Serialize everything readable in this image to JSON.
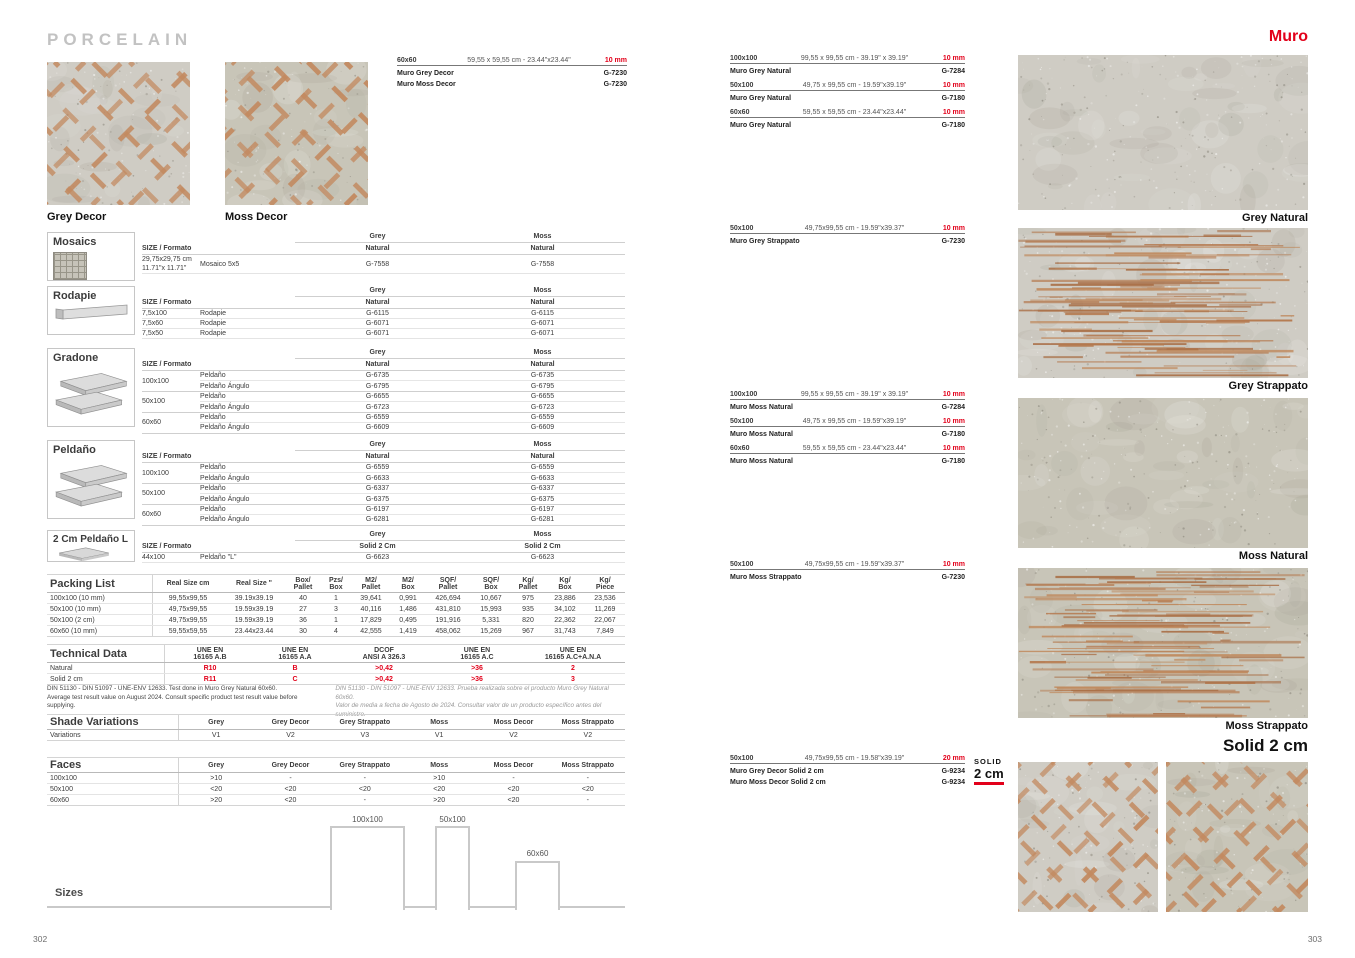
{
  "colors": {
    "accent": "#e2001a",
    "tile_grey": "#cfccc4",
    "tile_moss": "#c8c5b8",
    "dash": "#c38a60",
    "streak": "#b5794e"
  },
  "shared": {
    "size_header": "SIZE / Formato",
    "grey": "Grey",
    "moss": "Moss",
    "natural": "Natural",
    "solid": "Solid 2 Cm"
  },
  "left_page": {
    "brand_title": "PORCELAIN",
    "page_number": "302",
    "hero_tiles": [
      {
        "label": "Grey Decor"
      },
      {
        "label": "Moss Decor"
      }
    ],
    "top_spec": {
      "size": "60x60",
      "dims": "59,55 x 59,55 cm - 23.44\"x23.44\"",
      "thickness": "10 mm",
      "products": [
        {
          "name": "Muro Grey Decor",
          "code": "G-7230"
        },
        {
          "name": "Muro Moss Decor",
          "code": "G-7230"
        }
      ]
    },
    "mosaics": {
      "title": "Mosaics",
      "rows": [
        {
          "size": "29,75x29,75 cm\n11.71\"x 11.71\"",
          "product": "Mosaico 5x5",
          "grey": "G-7558",
          "moss": "G-7558"
        }
      ]
    },
    "rodapie": {
      "title": "Rodapie",
      "rows": [
        {
          "size": "7,5x100",
          "product": "Rodapie",
          "grey": "G-6115",
          "moss": "G-6115"
        },
        {
          "size": "7,5x60",
          "product": "Rodapie",
          "grey": "G-6071",
          "moss": "G-6071"
        },
        {
          "size": "7,5x50",
          "product": "Rodapie",
          "grey": "G-6071",
          "moss": "G-6071"
        }
      ]
    },
    "gradone": {
      "title": "Gradone",
      "groups": [
        {
          "size": "100x100",
          "items": [
            {
              "product": "Peldaño",
              "grey": "G-6735",
              "moss": "G-6735"
            },
            {
              "product": "Peldaño Ángulo",
              "grey": "G-6795",
              "moss": "G-6795"
            }
          ]
        },
        {
          "size": "50x100",
          "items": [
            {
              "product": "Peldaño",
              "grey": "G-6655",
              "moss": "G-6655"
            },
            {
              "product": "Peldaño Ángulo",
              "grey": "G-6723",
              "moss": "G-6723"
            }
          ]
        },
        {
          "size": "60x60",
          "items": [
            {
              "product": "Peldaño",
              "grey": "G-6559",
              "moss": "G-6559"
            },
            {
              "product": "Peldaño Ángulo",
              "grey": "G-6609",
              "moss": "G-6609"
            }
          ]
        }
      ]
    },
    "peldano": {
      "title": "Peldaño",
      "groups": [
        {
          "size": "100x100",
          "items": [
            {
              "product": "Peldaño",
              "grey": "G-6559",
              "moss": "G-6559"
            },
            {
              "product": "Peldaño Ángulo",
              "grey": "G-6633",
              "moss": "G-6633"
            }
          ]
        },
        {
          "size": "50x100",
          "items": [
            {
              "product": "Peldaño",
              "grey": "G-6337",
              "moss": "G-6337"
            },
            {
              "product": "Peldaño Ángulo",
              "grey": "G-6375",
              "moss": "G-6375"
            }
          ]
        },
        {
          "size": "60x60",
          "items": [
            {
              "product": "Peldaño",
              "grey": "G-6197",
              "moss": "G-6197"
            },
            {
              "product": "Peldaño Ángulo",
              "grey": "G-6281",
              "moss": "G-6281"
            }
          ]
        }
      ]
    },
    "peldano_l": {
      "title": "2 Cm Peldaño L",
      "rows": [
        {
          "size": "44x100",
          "product": "Peldaño \"L\"",
          "grey": "G-6623",
          "moss": "G-6623"
        }
      ]
    },
    "packing": {
      "title": "Packing List",
      "headers": [
        "Real Size cm",
        "Real Size \"",
        "Box/\nPallet",
        "Pzs/\nBox",
        "M2/\nPallet",
        "M2/\nBox",
        "SQF/\nPallet",
        "SQF/\nBox",
        "Kg/\nPallet",
        "Kg/\nBox",
        "Kg/\nPiece"
      ],
      "rows": [
        {
          "label": "100x100 (10 mm)",
          "values": [
            "99,55x99,55",
            "39.19x39.19",
            "40",
            "1",
            "39,641",
            "0,991",
            "426,694",
            "10,667",
            "975",
            "23,886",
            "23,536"
          ]
        },
        {
          "label": "50x100 (10 mm)",
          "values": [
            "49,75x99,55",
            "19.59x39.19",
            "27",
            "3",
            "40,116",
            "1,486",
            "431,810",
            "15,993",
            "935",
            "34,102",
            "11,269"
          ]
        },
        {
          "label": "50x100 (2 cm)",
          "values": [
            "49,75x99,55",
            "19.59x39.19",
            "36",
            "1",
            "17,829",
            "0,495",
            "191,916",
            "5,331",
            "820",
            "22,362",
            "22,067"
          ]
        },
        {
          "label": "60x60 (10 mm)",
          "values": [
            "59,55x59,55",
            "23.44x23.44",
            "30",
            "4",
            "42,555",
            "1,419",
            "458,062",
            "15,269",
            "967",
            "31,743",
            "7,849"
          ]
        }
      ]
    },
    "technical": {
      "title": "Technical Data",
      "headers": [
        "UNE EN\n16165 A.B",
        "UNE EN\n16165 A.A",
        "DCOF\nANSI A 326.3",
        "UNE EN\n16165 A.C",
        "UNE EN\n16165 A.C+A.N.A"
      ],
      "rows": [
        {
          "label": "Natural",
          "values": [
            "R10",
            "B",
            ">0,42",
            ">36",
            "2"
          ]
        },
        {
          "label": "Solid 2 cm",
          "values": [
            "R11",
            "C",
            ">0,42",
            ">36",
            "3"
          ]
        }
      ],
      "note_left": "DIN 51130 - DIN 51097 - UNE-ENV 12633. Test done in Muro Grey Natural 60x60.\nAverage test result value on August 2024. Consult specific product test result value before supplying.",
      "note_right": "DIN 51130 - DIN 51097 - UNE-ENV 12633. Prueba realizada sobre el producto Muro Grey Natural 60x60.\nValor de media a fecha de Agosto de 2024. Consultar valor de un producto específico antes del suministro."
    },
    "shade": {
      "title": "Shade Variations",
      "row_label": "Variations",
      "columns": [
        "Grey",
        "Grey Decor",
        "Grey Strappato",
        "Moss",
        "Moss Decor",
        "Moss Strappato"
      ],
      "values": [
        "V1",
        "V2",
        "V3",
        "V1",
        "V2",
        "V2"
      ]
    },
    "faces": {
      "title": "Faces",
      "columns": [
        "Grey",
        "Grey Decor",
        "Grey Strappato",
        "Moss",
        "Moss Decor",
        "Moss Strappato"
      ],
      "rows": [
        {
          "label": "100x100",
          "values": [
            ">10",
            "-",
            "-",
            ">10",
            "-",
            "-"
          ]
        },
        {
          "label": "50x100",
          "values": [
            "<20",
            "<20",
            "<20",
            "<20",
            "<20",
            "<20"
          ]
        },
        {
          "label": "60x60",
          "values": [
            ">20",
            "<20",
            "-",
            ">20",
            "<20",
            "-"
          ]
        }
      ]
    },
    "sizes": {
      "title": "Sizes",
      "boxes": [
        {
          "label": "100x100"
        },
        {
          "label": "50x100"
        },
        {
          "label": "60x60"
        }
      ]
    }
  },
  "right_page": {
    "collection_title": "Muro",
    "page_number": "303",
    "spec_groups": [
      {
        "entries": [
          {
            "size": "100x100",
            "dims": "99,55 x 99,55 cm - 39.19\" x 39.19\"",
            "thickness": "10 mm",
            "products": [
              {
                "name": "Muro Grey Natural",
                "code": "G-7284"
              }
            ]
          },
          {
            "size": "50x100",
            "dims": "49,75 x 99,55 cm - 19.59\"x39.19\"",
            "thickness": "10 mm",
            "products": [
              {
                "name": "Muro Grey Natural",
                "code": "G-7180"
              }
            ]
          },
          {
            "size": "60x60",
            "dims": "59,55 x 59,55 cm - 23.44\"x23.44\"",
            "thickness": "10 mm",
            "products": [
              {
                "name": "Muro Grey Natural",
                "code": "G-7180"
              }
            ]
          }
        ]
      },
      {
        "entries": [
          {
            "size": "50x100",
            "dims": "49,75x99,55 cm - 19.59\"x39.37\"",
            "thickness": "10 mm",
            "products": [
              {
                "name": "Muro Grey Strappato",
                "code": "G-7230"
              }
            ]
          }
        ]
      },
      {
        "entries": [
          {
            "size": "100x100",
            "dims": "99,55 x 99,55 cm - 39.19\" x 39.19\"",
            "thickness": "10 mm",
            "products": [
              {
                "name": "Muro Moss Natural",
                "code": "G-7284"
              }
            ]
          },
          {
            "size": "50x100",
            "dims": "49,75 x 99,55 cm - 19.59\"x39.19\"",
            "thickness": "10 mm",
            "products": [
              {
                "name": "Muro Moss Natural",
                "code": "G-7180"
              }
            ]
          },
          {
            "size": "60x60",
            "dims": "59,55 x 59,55 cm - 23.44\"x23.44\"",
            "thickness": "10 mm",
            "products": [
              {
                "name": "Muro Moss Natural",
                "code": "G-7180"
              }
            ]
          }
        ]
      },
      {
        "entries": [
          {
            "size": "50x100",
            "dims": "49,75x99,55 cm - 19.59\"x39.37\"",
            "thickness": "10 mm",
            "products": [
              {
                "name": "Muro Moss Strappato",
                "code": "G-7230"
              }
            ]
          }
        ]
      },
      {
        "entries": [
          {
            "size": "50x100",
            "dims": "49,75x99,55 cm - 19.58\"x39.19\"",
            "thickness": "20 mm",
            "products": [
              {
                "name": "Muro Grey Decor Solid 2 cm",
                "code": "G-9234"
              },
              {
                "name": "Muro Moss Decor Solid 2 cm",
                "code": "G-9234"
              }
            ]
          }
        ]
      }
    ],
    "solid_badge": {
      "line1": "SOLID",
      "line2": "2 cm"
    },
    "images": [
      {
        "caption": "Grey Natural"
      },
      {
        "caption": "Grey Strappato"
      },
      {
        "caption": "Moss Natural"
      },
      {
        "caption": "Moss Strappato"
      }
    ],
    "solid_heading": "Solid 2 cm"
  }
}
